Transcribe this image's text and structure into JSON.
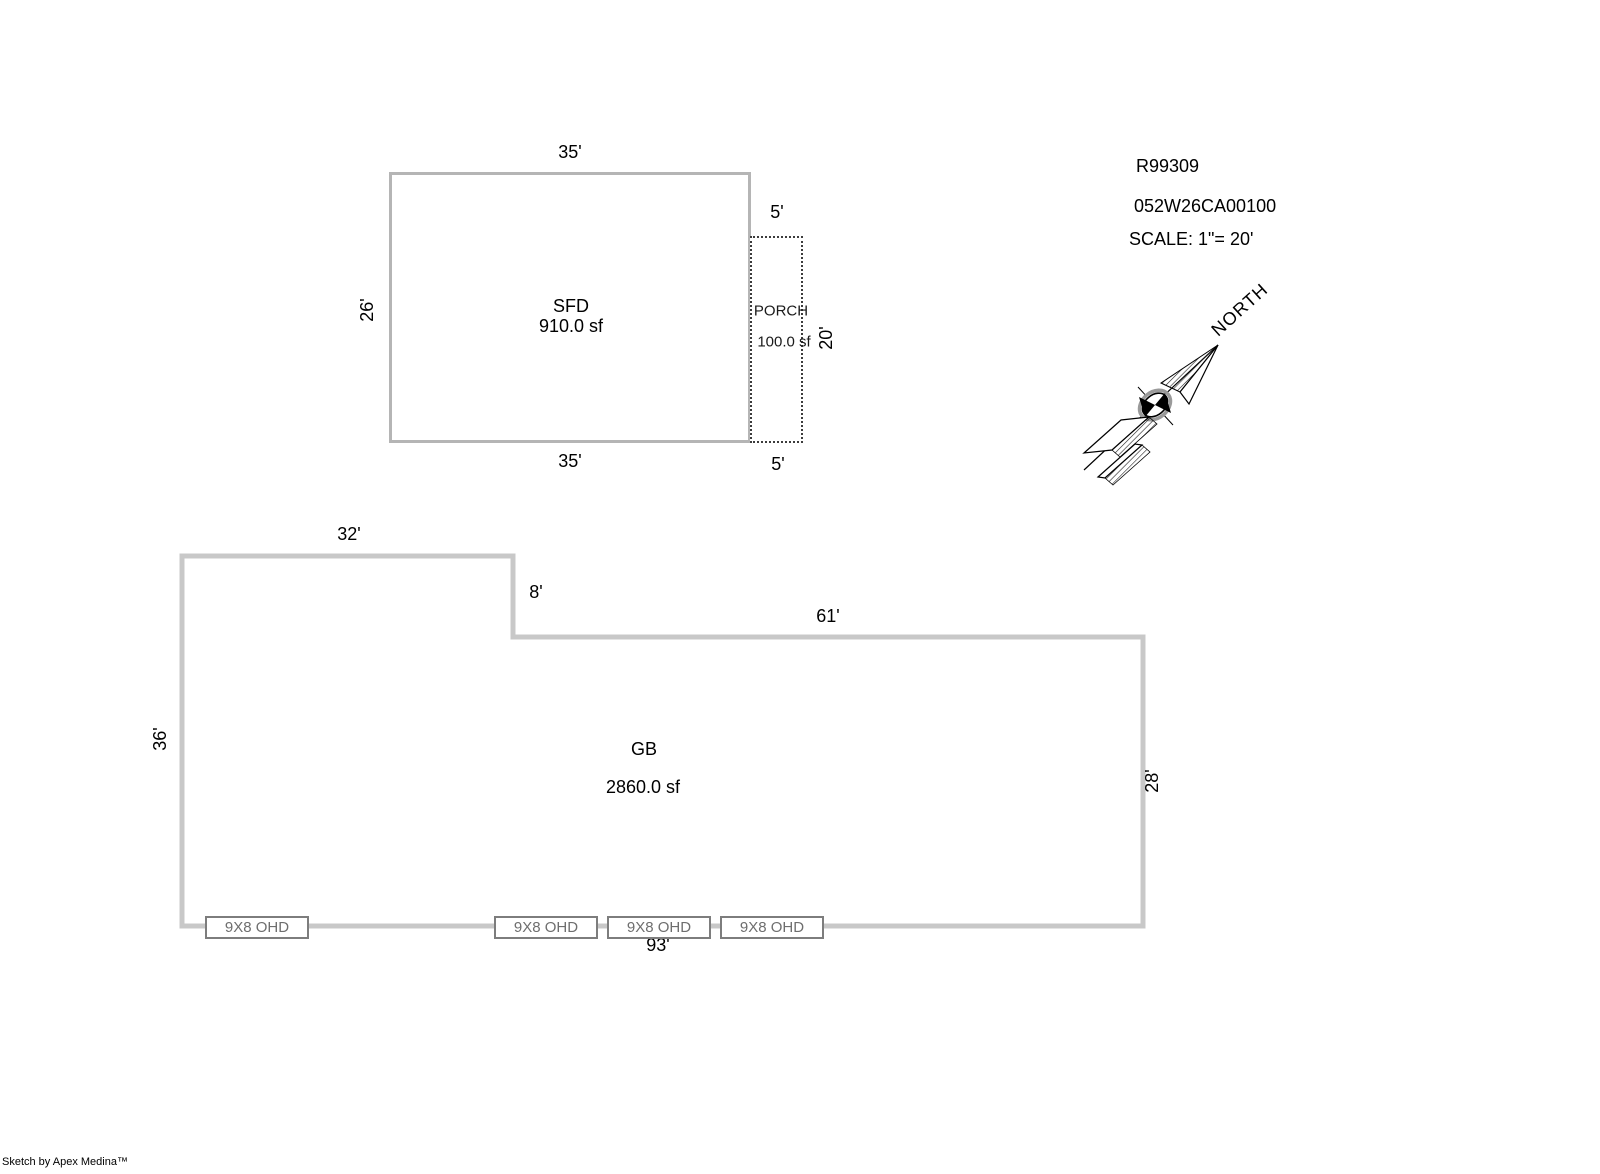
{
  "header": {
    "record_id": "R99309",
    "parcel_id": "052W26CA00100",
    "scale_label": "SCALE: 1\"= 20'"
  },
  "compass": {
    "label": "NORTH"
  },
  "sfd": {
    "name": "SFD",
    "area": "910.0 sf",
    "dims": {
      "top": "35'",
      "left": "26'",
      "bottom": "35'"
    }
  },
  "porch": {
    "name": "PORCH",
    "area": "100.0 sf",
    "dims": {
      "top": "5'",
      "right": "20'",
      "bottom": "5'"
    }
  },
  "gb": {
    "name": "GB",
    "area": "2860.0 sf",
    "dims": {
      "top_left": "32'",
      "step": "8'",
      "top_right": "61'",
      "left": "36'",
      "right": "28'",
      "bottom": "93'"
    }
  },
  "doors": [
    "9X8 OHD",
    "9X8 OHD",
    "9X8 OHD",
    "9X8 OHD"
  ],
  "footer": {
    "credit": "Sketch by Apex Medina™"
  },
  "colors": {
    "sfd_outline": "#b5b5b5",
    "gb_outline": "#c8c8c8",
    "porch_outline": "#3c3c3c",
    "door_border": "#7d7d7d",
    "door_text": "#6e6e6e",
    "text": "#000000",
    "background": "#ffffff"
  }
}
